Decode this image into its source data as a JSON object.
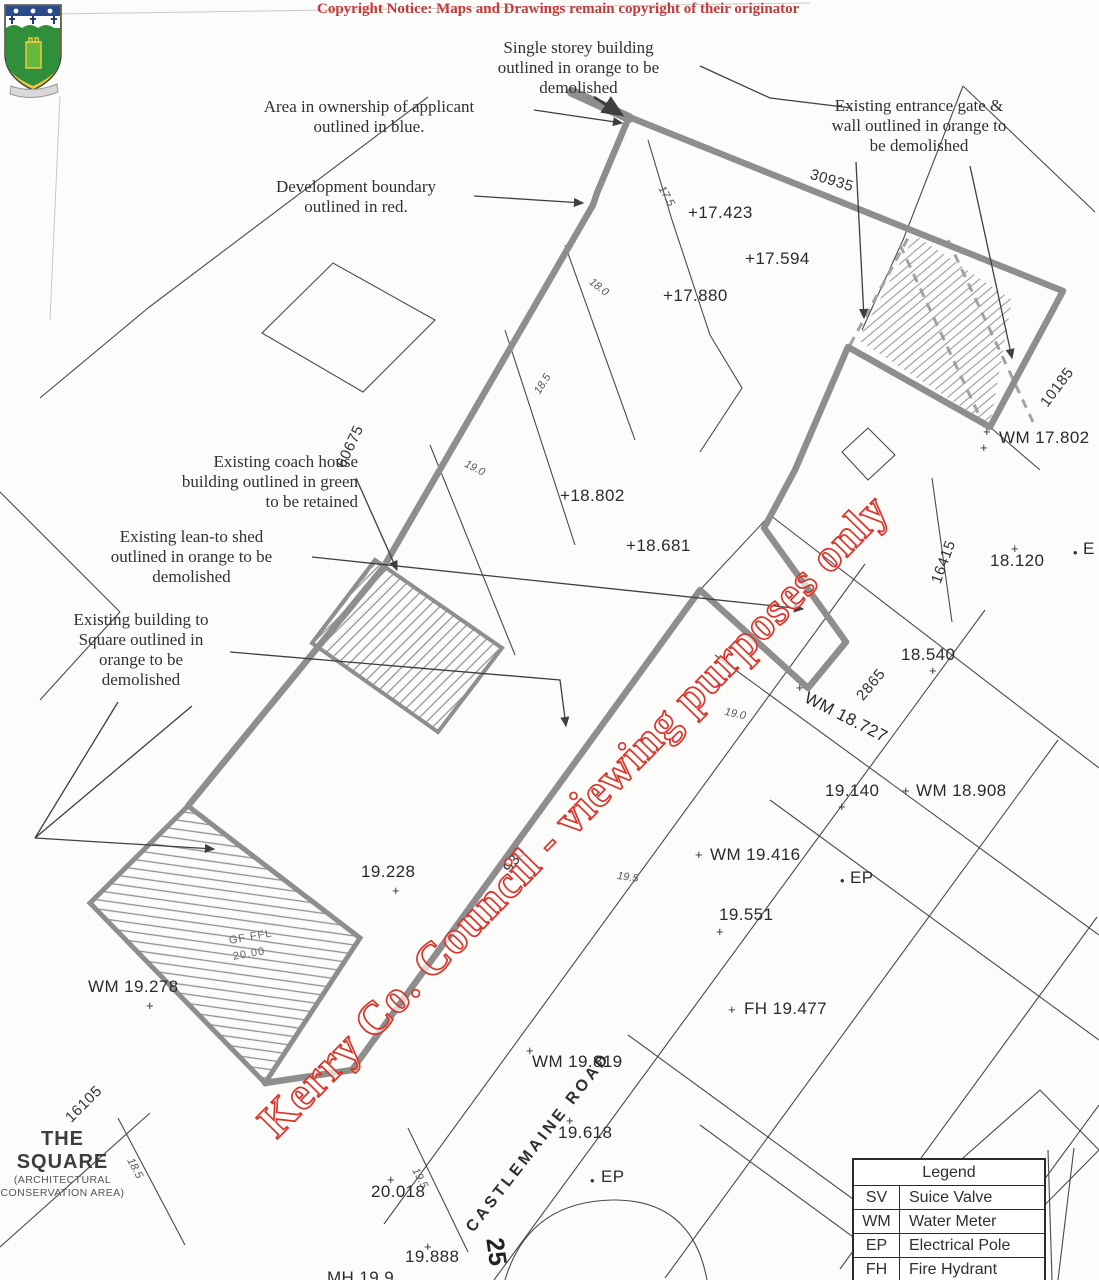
{
  "page": {
    "copyright_notice": "Copyright Notice: Maps and Drawings remain copyright of their originator",
    "watermark": "Kerry Co. Council - viewing purposes only"
  },
  "colors": {
    "copyright_red": "#c03a3a",
    "watermark_stroke": "#d8362c",
    "boundary_gray": "#8e8e8e",
    "line_dark": "#3f3f3f",
    "crest_green": "#2f8f3a",
    "crest_yellow": "#f0c93c",
    "crest_navy": "#2b4a8b"
  },
  "annotations": [
    {
      "name": "note-single-storey",
      "x": 471,
      "y": 38,
      "w": 215,
      "align": "center",
      "lines": [
        "Single storey building",
        "outlined in orange to be",
        "demolished"
      ]
    },
    {
      "name": "note-area-ownership",
      "x": 208,
      "y": 97,
      "w": 322,
      "align": "center",
      "lines": [
        "Area in ownership of applicant",
        "outlined in blue."
      ]
    },
    {
      "name": "note-entrance-gate",
      "x": 748,
      "y": 96,
      "w": 342,
      "align": "center",
      "lines": [
        "Existing entrance gate &",
        "wall outlined in orange to",
        "be demolished"
      ]
    },
    {
      "name": "note-dev-boundary",
      "x": 240,
      "y": 177,
      "w": 232,
      "align": "center",
      "lines": [
        "Development boundary",
        "outlined in red."
      ]
    },
    {
      "name": "note-coach-house",
      "x": 130,
      "y": 452,
      "w": 228,
      "align": "right",
      "lines": [
        "Existing coach house",
        "building outlined in green",
        "to be retained"
      ]
    },
    {
      "name": "note-lean-to",
      "x": 70,
      "y": 527,
      "w": 243,
      "align": "center",
      "lines": [
        "Existing lean-to shed",
        "outlined in orange to be",
        "demolished"
      ]
    },
    {
      "name": "note-building-square",
      "x": 46,
      "y": 610,
      "w": 190,
      "align": "center",
      "lines": [
        "Existing building to",
        "Square outlined in",
        "orange to be",
        "demolished"
      ]
    }
  ],
  "map": {
    "labels": [
      {
        "t": "+17.423",
        "x": 688,
        "y": 203,
        "c": "spot",
        "n": "spot-height-17423"
      },
      {
        "t": "+17.594",
        "x": 745,
        "y": 249,
        "c": "spot",
        "n": "spot-height-17594"
      },
      {
        "t": "+17.880",
        "x": 663,
        "y": 286,
        "c": "spot",
        "n": "spot-height-17880"
      },
      {
        "t": "+18.802",
        "x": 560,
        "y": 486,
        "c": "spot",
        "n": "spot-height-18802"
      },
      {
        "t": "+18.681",
        "x": 626,
        "y": 536,
        "c": "spot",
        "n": "spot-height-18681"
      },
      {
        "t": "WM 17.802",
        "x": 999,
        "y": 428,
        "c": "spot",
        "n": "water-meter-17802"
      },
      {
        "t": "+",
        "x": 983,
        "y": 424,
        "c": "marker",
        "n": "cross-marker"
      },
      {
        "t": "+",
        "x": 980,
        "y": 440,
        "c": "marker",
        "n": "cross-marker"
      },
      {
        "t": "18.120",
        "x": 990,
        "y": 551,
        "c": "spot",
        "n": "spot-height-18120"
      },
      {
        "t": "+",
        "x": 1011,
        "y": 541,
        "c": "marker",
        "n": "cross-marker"
      },
      {
        "t": "E",
        "x": 1083,
        "y": 539,
        "c": "spot",
        "n": "ep-partial"
      },
      {
        "t": "•",
        "x": 1073,
        "y": 545,
        "c": "marker",
        "n": "point-marker"
      },
      {
        "t": "18.540",
        "x": 901,
        "y": 645,
        "c": "spot",
        "n": "spot-height-18540"
      },
      {
        "t": "+",
        "x": 929,
        "y": 663,
        "c": "marker",
        "n": "cross-marker"
      },
      {
        "t": "WM 18.727",
        "x": 810,
        "y": 688,
        "r": 27,
        "c": "spot",
        "n": "water-meter-18727"
      },
      {
        "t": "+",
        "x": 796,
        "y": 680,
        "c": "marker",
        "n": "cross-marker"
      },
      {
        "t": "2865",
        "x": 853,
        "y": 693,
        "r": -50,
        "c": "dim",
        "n": "dimension-2865"
      },
      {
        "t": "19.140",
        "x": 825,
        "y": 781,
        "c": "spot",
        "n": "spot-height-19140"
      },
      {
        "t": "+",
        "x": 838,
        "y": 799,
        "c": "marker",
        "n": "cross-marker"
      },
      {
        "t": "WM 18.908",
        "x": 916,
        "y": 781,
        "c": "spot",
        "n": "water-meter-18908"
      },
      {
        "t": "+",
        "x": 902,
        "y": 783,
        "c": "marker",
        "n": "cross-marker"
      },
      {
        "t": "WM 19.416",
        "x": 710,
        "y": 845,
        "c": "spot",
        "n": "water-meter-19416"
      },
      {
        "t": "+",
        "x": 695,
        "y": 847,
        "c": "marker",
        "n": "cross-marker"
      },
      {
        "t": "EP",
        "x": 850,
        "y": 868,
        "c": "spot",
        "n": "electrical-pole-label"
      },
      {
        "t": "•",
        "x": 840,
        "y": 873,
        "c": "marker",
        "n": "point-marker"
      },
      {
        "t": "19.551",
        "x": 719,
        "y": 905,
        "c": "spot",
        "n": "spot-height-19551"
      },
      {
        "t": "+",
        "x": 716,
        "y": 924,
        "c": "marker",
        "n": "cross-marker"
      },
      {
        "t": "FH 19.477",
        "x": 744,
        "y": 999,
        "c": "spot",
        "n": "fire-hydrant-19477"
      },
      {
        "t": "+",
        "x": 728,
        "y": 1002,
        "c": "marker",
        "n": "cross-marker"
      },
      {
        "t": "WM 19.819",
        "x": 532,
        "y": 1052,
        "c": "spot",
        "n": "water-meter-19819"
      },
      {
        "t": "+",
        "x": 526,
        "y": 1043,
        "c": "marker",
        "n": "cross-marker"
      },
      {
        "t": "19.618",
        "x": 558,
        "y": 1123,
        "c": "spot",
        "n": "spot-height-19618"
      },
      {
        "t": "+",
        "x": 566,
        "y": 1113,
        "c": "marker",
        "n": "cross-marker"
      },
      {
        "t": "EP",
        "x": 601,
        "y": 1167,
        "c": "spot",
        "n": "electrical-pole-label"
      },
      {
        "t": "•",
        "x": 590,
        "y": 1173,
        "c": "marker",
        "n": "point-marker"
      },
      {
        "t": "19.228",
        "x": 361,
        "y": 862,
        "c": "spot",
        "n": "spot-height-19228"
      },
      {
        "t": "+",
        "x": 392,
        "y": 883,
        "c": "marker",
        "n": "cross-marker"
      },
      {
        "t": "WM 19.278",
        "x": 88,
        "y": 977,
        "c": "spot",
        "n": "water-meter-19278"
      },
      {
        "t": "+",
        "x": 146,
        "y": 998,
        "c": "marker",
        "n": "cross-marker"
      },
      {
        "t": "20.018",
        "x": 371,
        "y": 1182,
        "c": "spot",
        "n": "spot-height-20018"
      },
      {
        "t": "+",
        "x": 387,
        "y": 1172,
        "c": "marker",
        "n": "cross-marker"
      },
      {
        "t": "19.888",
        "x": 405,
        "y": 1247,
        "c": "spot",
        "n": "spot-height-19888"
      },
      {
        "t": "+",
        "x": 424,
        "y": 1239,
        "c": "marker",
        "n": "cross-marker"
      },
      {
        "t": "MH 19.9",
        "x": 327,
        "y": 1268,
        "c": "spot",
        "n": "manhole-partial"
      },
      {
        "t": "25",
        "x": 508,
        "y": 1236,
        "r": 82,
        "c": "big",
        "n": "plot-number-25"
      },
      {
        "t": "30935",
        "x": 813,
        "y": 166,
        "r": 17,
        "c": "dim",
        "n": "dimension-30935"
      },
      {
        "t": "10185",
        "x": 1037,
        "y": 400,
        "r": -53,
        "c": "dim",
        "n": "dimension-10185"
      },
      {
        "t": "16415",
        "x": 928,
        "y": 580,
        "r": -70,
        "c": "dim",
        "n": "dimension-16415"
      },
      {
        "t": "60675",
        "x": 333,
        "y": 463,
        "r": -65,
        "c": "dim",
        "n": "dimension-60675"
      },
      {
        "t": "16105",
        "x": 62,
        "y": 1114,
        "r": -45,
        "c": "dim",
        "n": "dimension-16105"
      },
      {
        "t": "930",
        "x": 500,
        "y": 866,
        "r": -55,
        "c": "dim",
        "n": "dimension-930"
      },
      {
        "t": "17.5",
        "x": 666,
        "y": 184,
        "r": 60,
        "c": "contour",
        "n": "contour-17-5"
      },
      {
        "t": "18.0",
        "x": 594,
        "y": 276,
        "r": 38,
        "c": "contour",
        "n": "contour-18-0"
      },
      {
        "t": "18.5",
        "x": 532,
        "y": 390,
        "r": -58,
        "c": "contour",
        "n": "contour-18-5"
      },
      {
        "t": "19.0",
        "x": 468,
        "y": 458,
        "r": 28,
        "c": "contour",
        "n": "contour-19-0"
      },
      {
        "t": "19.0",
        "x": 726,
        "y": 706,
        "r": 12,
        "c": "contour",
        "n": "contour-19-0"
      },
      {
        "t": "19.5",
        "x": 618,
        "y": 870,
        "r": 8,
        "c": "contour",
        "n": "contour-19-5"
      },
      {
        "t": "18.5",
        "x": 135,
        "y": 1156,
        "r": 62,
        "c": "contour",
        "n": "contour-18-5"
      },
      {
        "t": "19.5",
        "x": 420,
        "y": 1166,
        "r": 62,
        "c": "contour",
        "n": "contour-19-5"
      },
      {
        "t": "GF FFL",
        "x": 228,
        "y": 935,
        "r": -10,
        "c": "gf",
        "n": "gf-ffl-label"
      },
      {
        "t": "20.00",
        "x": 232,
        "y": 951,
        "r": -10,
        "c": "gf",
        "n": "gf-ffl-value"
      },
      {
        "t": "CASTLEMAINE ROAD",
        "x": 463,
        "y": 1225,
        "r": -52,
        "c": "road",
        "n": "road-name-castlemaine"
      }
    ]
  },
  "corner": {
    "title": "THE SQUARE",
    "sub1": "(ARCHITECTURAL",
    "sub2": "CONSERVATION AREA)"
  },
  "legend": {
    "title": "Legend",
    "rows": [
      {
        "abbr": "SV",
        "label": "Suice Valve"
      },
      {
        "abbr": "WM",
        "label": "Water Meter"
      },
      {
        "abbr": "EP",
        "label": "Electrical Pole"
      },
      {
        "abbr": "FH",
        "label": "Fire Hydrant"
      }
    ],
    "partial_row": {
      "abbr": "EO",
      "label": "Electric"
    }
  }
}
